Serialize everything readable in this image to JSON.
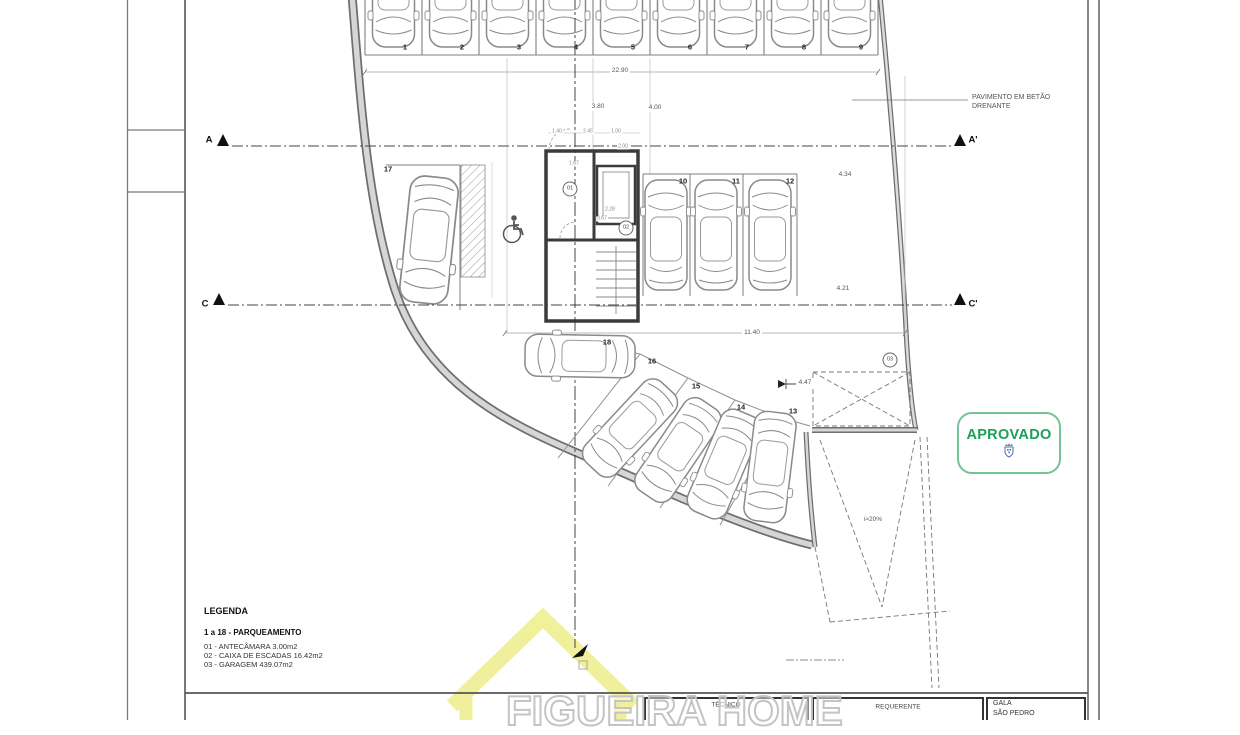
{
  "plan": {
    "parking_numbers": [
      "1",
      "2",
      "3",
      "4",
      "5",
      "6",
      "7",
      "8",
      "9",
      "10",
      "11",
      "12",
      "13",
      "14",
      "15",
      "16",
      "17",
      "18"
    ],
    "room_bubbles": [
      "01",
      "02",
      "03"
    ],
    "section_markers": [
      "A",
      "A'",
      "C",
      "C'"
    ],
    "dimensions": {
      "top_total": "22.90",
      "top_a": "3.80",
      "top_b": "4.00",
      "mid_total": "11.40",
      "right_a": "4.34",
      "right_b": "4.21",
      "level": "4.47",
      "ramp_slope": "i≈20%",
      "micro": [
        "1.40",
        "2.45",
        "1.00",
        "2.00",
        "1.67",
        "2.28",
        "3.67"
      ]
    },
    "note_line1": "PAVIMENTO EM BETÃO",
    "note_line2": "DRENANTE"
  },
  "legend": {
    "title": "LEGENDA",
    "subtitle": "1 a 18 - PARQUEAMENTO",
    "items": [
      "01 - ANTECÂMARA  3.00m2",
      "02 - CAIXA DE ESCADAS  16.42m2",
      "03 - GARAGEM 439.07m2"
    ]
  },
  "stamp": {
    "label": "APROVADO"
  },
  "title_block": {
    "tecnico": "TÉCNICO",
    "requerente": "REQUERENTE",
    "location_line1": "GALA",
    "location_line2": "SÃO PEDRO"
  },
  "watermark": {
    "text": "FIGUEIRA HOME"
  }
}
